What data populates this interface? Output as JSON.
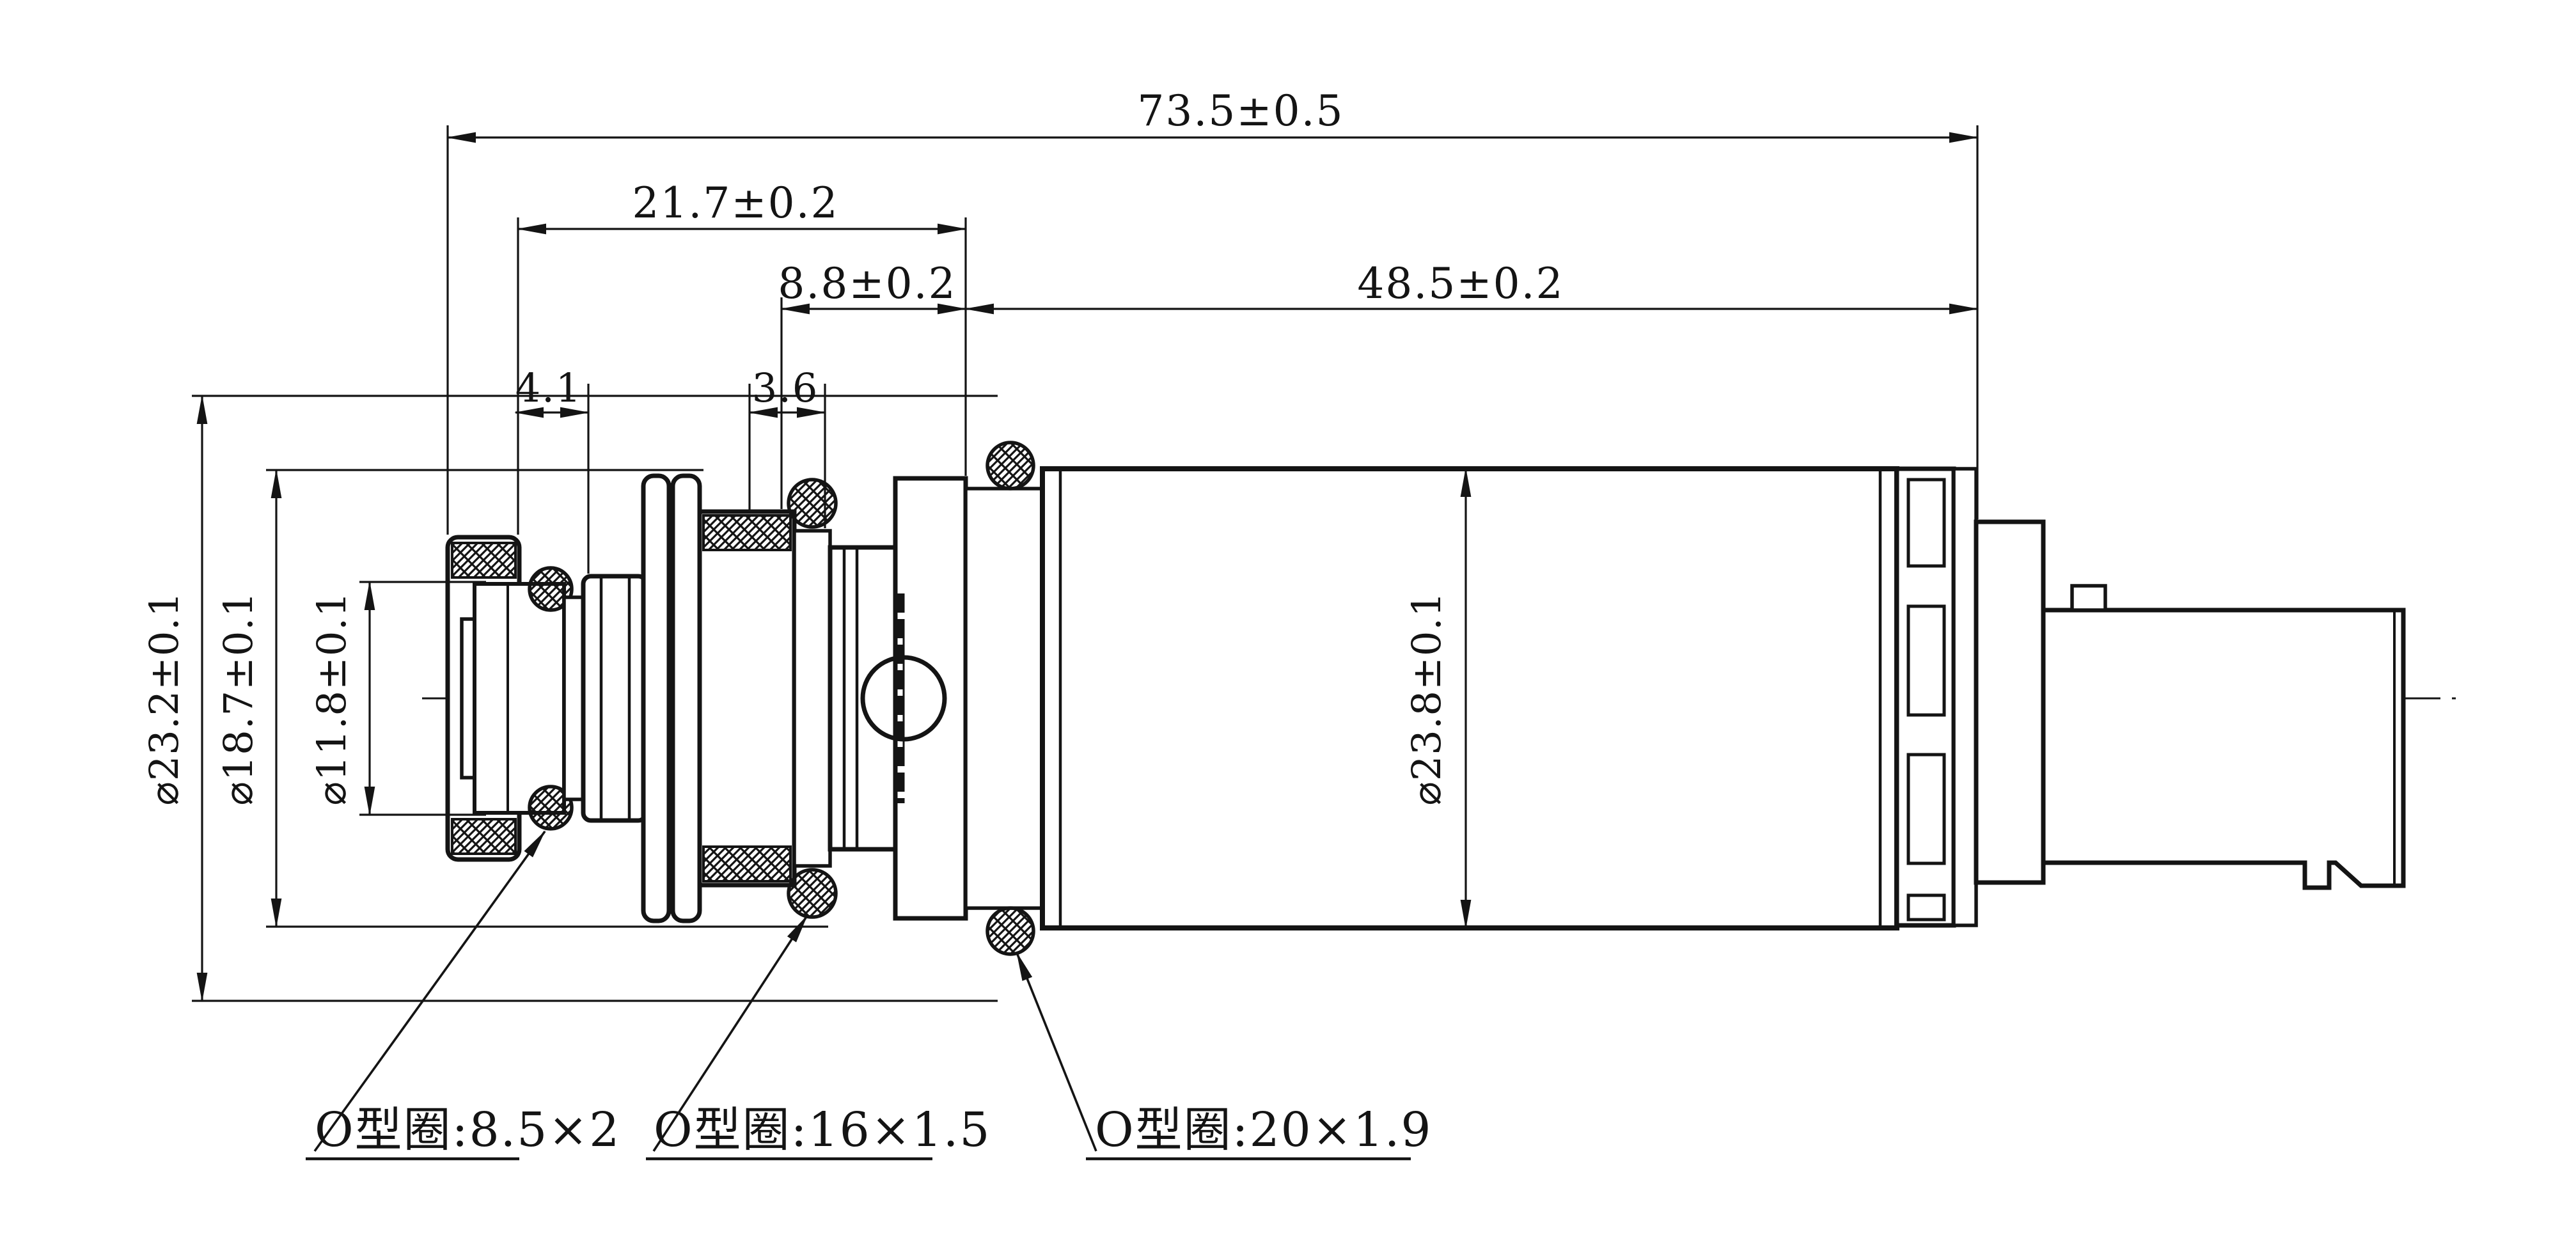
{
  "drawing": {
    "background": "#ffffff",
    "line_color": "#141414",
    "part": "solenoid-control-valve-cross-section",
    "dimensions": {
      "overall_length": "73.5±0.5",
      "front_section_length": "21.7±0.2",
      "mid_section_length": "8.8±0.2",
      "rear_section_length": "48.5±0.2",
      "front_groove_width": "4.1",
      "mid_groove_width": "3.6",
      "dia_outer_left": "⌀23.2±0.1",
      "dia_washer": "⌀18.7±0.1",
      "dia_tip": "⌀11.8±0.1",
      "dia_body": "⌀23.8±0.1"
    },
    "oring_labels": {
      "small": "O型圈:8.5×2",
      "medium": "O型圈:16×1.5",
      "large": "O型圈:20×1.9"
    }
  }
}
